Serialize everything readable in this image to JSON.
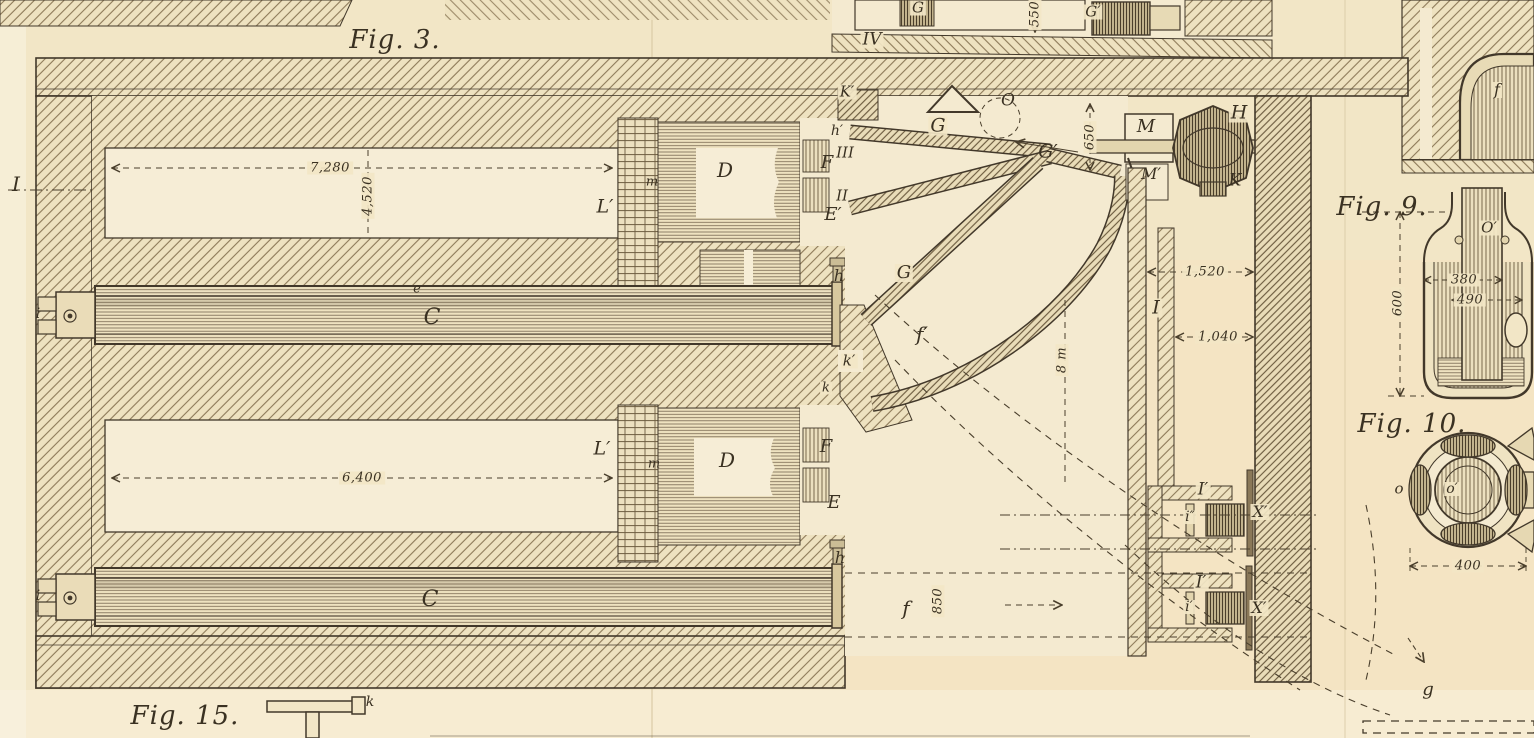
{
  "titles": {
    "fig3": "Fig. 3.",
    "fig9": "Fig. 9.",
    "fig10": "Fig. 10.",
    "fig15": "Fig. 15."
  },
  "dims": {
    "d7280": "7,280",
    "d4520": "4,520",
    "d6400": "6,400",
    "d650": "650",
    "d550": "550",
    "d1520": "1,520",
    "d1040": "1,040",
    "d850": "850",
    "d8m": "8 m",
    "d600": "600",
    "d380": "380",
    "d490": "490",
    "d400": "400"
  },
  "labels": {
    "sectI": "I",
    "sectII": "II",
    "sectIII": "III",
    "sectIV": "IV",
    "Kp": "K′",
    "O": "O",
    "G1": "G",
    "G2": "G",
    "Gp": "G′",
    "Gtop": "G",
    "Gptop": "G′",
    "M": "M",
    "Mp": "M′",
    "H": "H",
    "K": "K",
    "Iflue": "I",
    "Ip1": "I′",
    "Ip2": "I′",
    "ipp": "i″",
    "ip": "i′",
    "Xp1": "X′",
    "Xp2": "X′",
    "Lp1": "L′",
    "Lp2": "L′",
    "m1": "m",
    "m2": "m",
    "D1": "D",
    "D2": "D",
    "F1": "F",
    "F2": "F",
    "Ep": "E′",
    "E": "E",
    "hp": "h′",
    "h1": "h",
    "h2": "h",
    "kp": "k′",
    "k1": "k",
    "kfig15": "k",
    "C1": "C",
    "C2": "C",
    "e1": "e",
    "i1": "i",
    "i2": "i",
    "fp": "f′",
    "f1": "f",
    "ftop": "f",
    "g": "g",
    "Ofig9": "O′",
    "o1": "o",
    "op": "o′"
  }
}
